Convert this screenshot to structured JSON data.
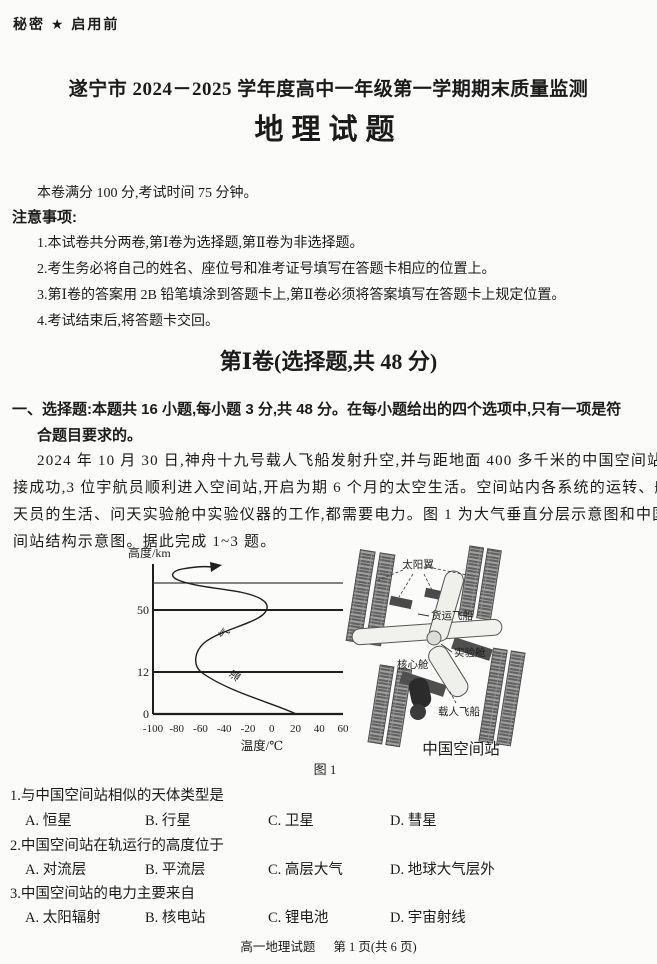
{
  "page": {
    "classification": "秘密 ★ 启用前",
    "title": "遂宁市 2024－2025 学年度高中一年级第一学期期末质量监测",
    "subject_title": "地理试题",
    "exam_info": "本卷满分 100 分,考试时间 75 分钟。",
    "notice_heading": "注意事项:",
    "notices": [
      "1.本试卷共分两卷,第Ⅰ卷为选择题,第Ⅱ卷为非选择题。",
      "2.考生务必将自己的姓名、座位号和准考证号填写在答题卡相应的位置上。",
      "3.第Ⅰ卷的答案用 2B 铅笔填涂到答题卡上,第Ⅱ卷必须将答案填写在答题卡上规定位置。",
      "4.考试结束后,将答题卡交回。"
    ],
    "section1": {
      "title": "第Ⅰ卷(选择题,共 48 分)",
      "instruction_lines": [
        "一、选择题:本题共 16 小题,每小题 3 分,共 48 分。在每小题给出的四个选项中,只有一项是符",
        "合题目要求的。"
      ]
    },
    "passage": [
      "2024 年 10 月 30 日,神舟十九号载人飞船发射升空,并与距地面 400 多千米的中国空间站对",
      "接成功,3 位宇航员顺利进入空间站,开启为期 6 个月的太空生活。空间站内各系统的运转、航",
      "天员的生活、问天实验舱中实验仪器的工作,都需要电力。图 1 为大气垂直分层示意图和中国空",
      "间站结构示意图。据此完成 1~3 题。"
    ],
    "figure": {
      "chart": {
        "y_axis_label": "高度/km",
        "x_axis_label": "温度/℃",
        "y_ticks": [
          "50",
          "12",
          "0"
        ],
        "x_ticks": [
          "-100",
          "-80",
          "-60",
          "-40",
          "-20",
          "0",
          "20",
          "40",
          "60"
        ],
        "curve_chars": [
          "气",
          "温"
        ]
      },
      "station": {
        "labels": {
          "solar": "太阳翼",
          "cargo": "货运飞船",
          "lab": "实验舱",
          "core": "核心舱",
          "crew": "载人飞船"
        },
        "caption": "中国空间站"
      },
      "caption": "图 1"
    },
    "questions": [
      {
        "stem": "1.与中国空间站相似的天体类型是",
        "options": [
          "A. 恒星",
          "B. 行星",
          "C. 卫星",
          "D. 彗星"
        ]
      },
      {
        "stem": "2.中国空间站在轨运行的高度位于",
        "options": [
          "A. 对流层",
          "B. 平流层",
          "C. 高层大气",
          "D. 地球大气层外"
        ]
      },
      {
        "stem": "3.中国空间站的电力主要来自",
        "options": [
          "A. 太阳辐射",
          "B. 核电站",
          "C. 锂电池",
          "D. 宇宙射线"
        ]
      }
    ],
    "footer": {
      "left": "高一地理试题",
      "right": "第 1 页(共 6 页)"
    }
  },
  "chart_data": {
    "type": "line",
    "title": "大气垂直分层示意图(气温随高度变化)",
    "xlabel": "温度/℃",
    "ylabel": "高度/km",
    "xlim": [
      -100,
      60
    ],
    "ylim": [
      0,
      95
    ],
    "x_ticks": [
      -100,
      -80,
      -60,
      -40,
      -20,
      0,
      20,
      40,
      60
    ],
    "y_ticks": [
      0,
      12,
      50
    ],
    "grid": true,
    "gridline_heights_km": [
      0,
      12,
      50,
      85
    ],
    "legend_position": "none",
    "series": [
      {
        "name": "气温",
        "points_temp_c_height_km": [
          [
            20,
            0
          ],
          [
            -20,
            6
          ],
          [
            -60,
            12
          ],
          [
            -62,
            16
          ],
          [
            -45,
            30
          ],
          [
            -20,
            42
          ],
          [
            -5,
            50
          ],
          [
            -25,
            62
          ],
          [
            -60,
            75
          ],
          [
            -85,
            85
          ],
          [
            -70,
            90
          ],
          [
            -45,
            94
          ]
        ],
        "annotation": "曲线顶端带箭头,表示高层大气中气温随高度继续上升"
      }
    ]
  }
}
